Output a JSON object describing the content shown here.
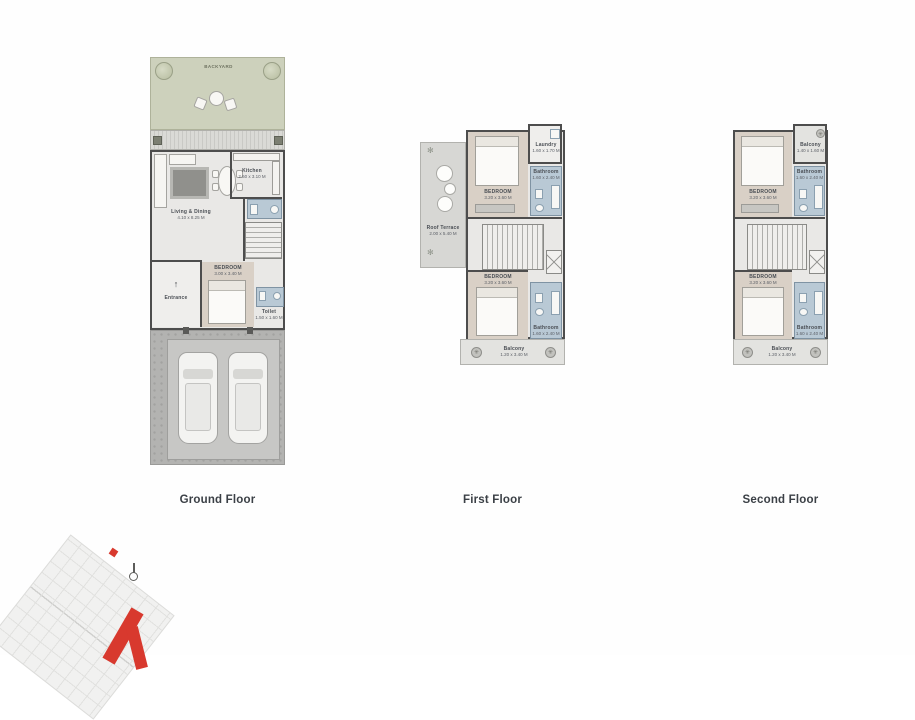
{
  "floors": {
    "ground": {
      "label": "Ground Floor",
      "backyard": "BACKYARD",
      "living_name": "Living & Dining",
      "living_dims": "4.10 x 8.25 M",
      "kitchen_name": "Kitchen",
      "kitchen_dims": "2.60 x 3.10 M",
      "entrance": "Entrance",
      "bedroom_name": "BEDROOM",
      "bedroom_dims": "3.00 x 3.40 M",
      "toilet_name": "Toilet",
      "toilet_dims": "1.50 x 1.60 M"
    },
    "first": {
      "label": "First Floor",
      "terrace_name": "Roof Terrace",
      "terrace_dims": "2.00 x 5.40 M",
      "laundry_name": "Laundry",
      "laundry_dims": "1.60 x 1.70 M",
      "bedroom1_name": "BEDROOM",
      "bedroom1_dims": "3.20 x 3.60 M",
      "bathroom1_name": "Bathroom",
      "bathroom1_dims": "1.60 x 2.40 M",
      "bedroom2_name": "BEDROOM",
      "bedroom2_dims": "3.20 x 3.60 M",
      "bathroom2_name": "Bathroom",
      "bathroom2_dims": "1.60 x 2.40 M",
      "balcony_name": "Balcony",
      "balcony_dims": "1.20 x 3.40 M"
    },
    "second": {
      "label": "Second Floor",
      "balcony_top_name": "Balcony",
      "balcony_top_dims": "1.40 x 1.60 M",
      "bedroom1_name": "BEDROOM",
      "bedroom1_dims": "3.20 x 3.60 M",
      "bathroom1_name": "Bathroom",
      "bathroom1_dims": "1.60 x 2.40 M",
      "bedroom2_name": "BEDROOM",
      "bedroom2_dims": "3.20 x 3.60 M",
      "bathroom2_name": "Bathroom",
      "bathroom2_dims": "1.60 x 2.40 M",
      "balcony_name": "Balcony",
      "balcony_dims": "1.20 x 3.40 M"
    }
  },
  "colors": {
    "garden_green": "#cdd1bc",
    "bathroom_blue": "#b9c9d5",
    "bedroom_beige": "#d9d0c6",
    "wall_gray": "#4d4d4d",
    "highlight_red": "#d8392e"
  }
}
